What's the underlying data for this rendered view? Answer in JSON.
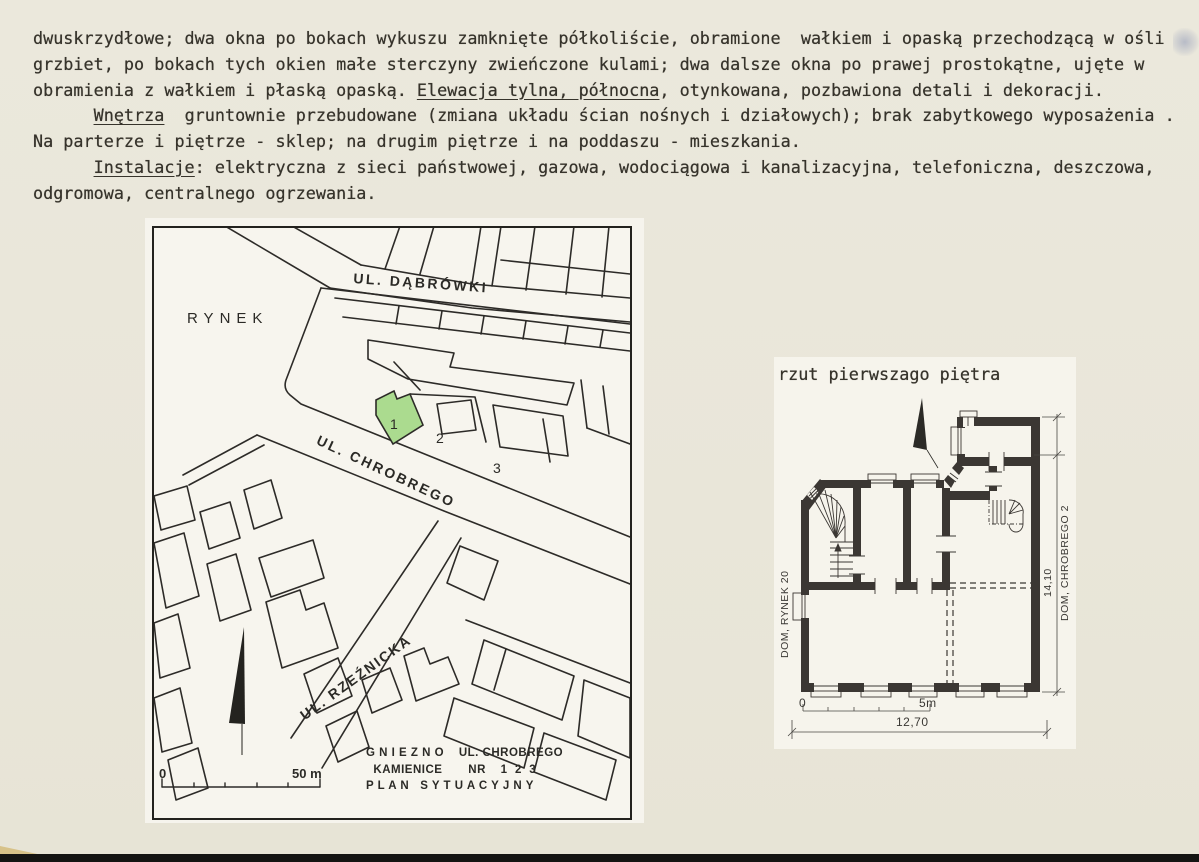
{
  "page": {
    "background": "#e9e6d9",
    "text_color": "#36332b"
  },
  "document_text": {
    "lines": [
      {
        "segments": [
          {
            "text": "dwuskrzydłowe; dwa okna po bokach wykuszu zamknięte półkoliście, obramione  wałkiem i opaską przechodzącą w ośli"
          }
        ]
      },
      {
        "segments": [
          {
            "text": "grzbiet, po bokach tych okien małe sterczyny zwieńczone kulami; dwa dalsze okna po prawej prostokątne, ujęte w"
          }
        ]
      },
      {
        "segments": [
          {
            "text": "obramienia z wałkiem i płaską opaską. "
          },
          {
            "text": "Elewacja tylna, północna",
            "underline": true
          },
          {
            "text": ", otynkowana, pozbawiona detali i dekoracji."
          }
        ]
      },
      {
        "segments": [
          {
            "text": "      "
          },
          {
            "text": "Wnętrza",
            "underline": true
          },
          {
            "text": "  gruntownie przebudowane (zmiana układu ścian nośnych i działowych); brak zabytkowego wyposażenia ."
          }
        ]
      },
      {
        "segments": [
          {
            "text": "Na parterze i piętrze - sklep; na drugim piętrze i na poddaszu - mieszkania."
          }
        ]
      },
      {
        "segments": [
          {
            "text": "      "
          },
          {
            "text": "Instalacje",
            "underline": true
          },
          {
            "text": ": elektryczna z sieci państwowej, gazowa, wodociągowa i kanalizacyjna, telefoniczna, deszczowa,"
          }
        ]
      },
      {
        "segments": [
          {
            "text": "odgromowa, centralnego ogrzewania."
          }
        ]
      }
    ]
  },
  "site_map": {
    "highlight_color": "#abdb8f",
    "labels": {
      "rynek": "RYNEK",
      "street_dabrowki": "UL. DĄBRÓWKI",
      "street_chrobrego": "UL. CHROBREGO",
      "street_rzeznicka": "UL. RZEŹNICKA",
      "parcel_1": "1",
      "parcel_2": "2",
      "parcel_3": "3",
      "scale_zero": "0",
      "scale_fifty": "50 m"
    },
    "caption_lines": [
      "G N I E Z N O    UL. CHROBREGO",
      "  KAMIENICE       NR    1  2  3",
      "P L A N   S Y T U A C Y J N Y"
    ]
  },
  "floor_plan": {
    "caption": "rzut pierwszago piętra",
    "labels": {
      "left_building": "DOM, RYNEK 20",
      "right_building": "DOM, CHROBREGO 2",
      "height_dim": "14,10",
      "width_dim": "12,70",
      "scale_zero": "0",
      "scale_five": "5m"
    }
  }
}
